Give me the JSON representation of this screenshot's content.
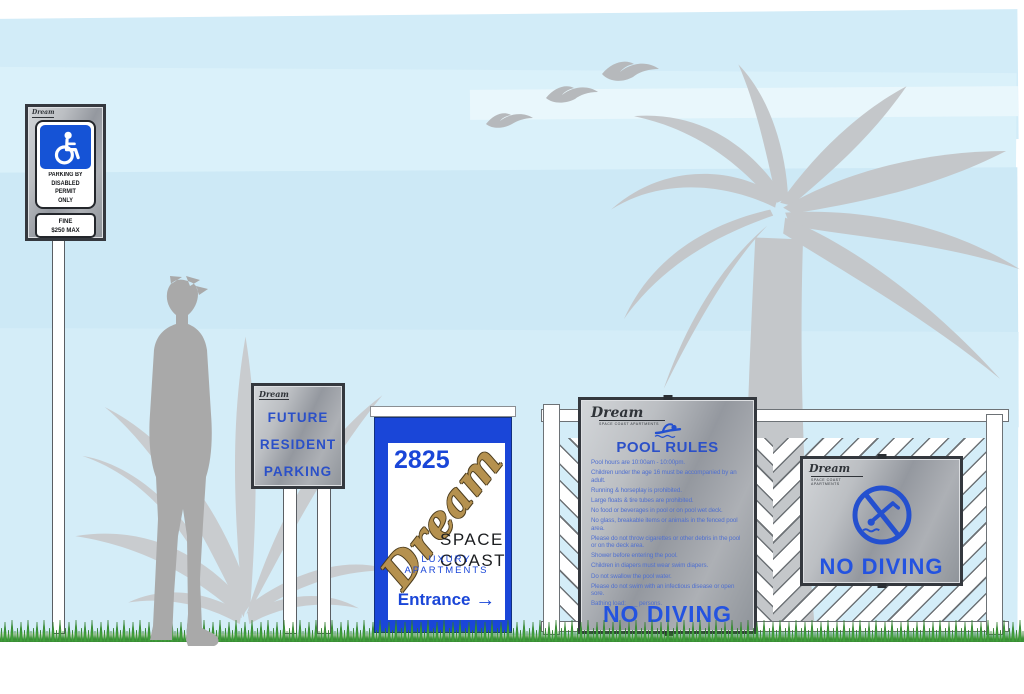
{
  "scene": {
    "description": "Signage package rendering for Dream Space Coast Luxury Apartments",
    "brand": "Dream",
    "brand_sub": "SPACE COAST APARTMENTS"
  },
  "signs": {
    "handicap": {
      "brand": "Dream",
      "permit_lines": [
        "PARKING BY",
        "DISABLED",
        "PERMIT",
        "ONLY"
      ],
      "fine_lines": [
        "FINE",
        "$250 MAX"
      ]
    },
    "future_parking": {
      "brand": "Dream",
      "lines": [
        "FUTURE",
        "RESIDENT",
        "PARKING"
      ]
    },
    "entrance": {
      "address": "2825",
      "brand_script": "Dream",
      "name_line1": "SPACE",
      "name_line2": "COAST",
      "subtitle": "LUXURY APARTMENTS",
      "entrance_label": "Entrance",
      "arrow": "→"
    },
    "pool_rules": {
      "brand": "Dream",
      "brand_sub": "SPACE COAST APARTMENTS",
      "title": "POOL RULES",
      "rules": [
        "Pool hours are 10:00am - 10:00pm.",
        "Children under the age 16 must be accompanied by an adult.",
        "Running & horseplay is prohibited.",
        "Large floats & tire tubes are prohibited.",
        "No food or beverages in pool or on pool wet deck.",
        "No glass, breakable items or animals in the fenced pool area.",
        "Please do not throw cigarettes or other debris in the pool or on the deck area.",
        "Shower before entering the pool.",
        "Children in diapers must wear swim diapers.",
        "Do not swallow the pool water.",
        "Please do not swim with an infectious disease or open sore.",
        "Bathing load: ___ persons."
      ],
      "footer": "NO DIVING"
    },
    "no_diving": {
      "brand": "Dream",
      "brand_sub": "SPACE COAST APARTMENTS",
      "label": "NO DIVING"
    }
  },
  "colors": {
    "sky": "#d2ecf8",
    "silhouette_gray": "#a9a9a9",
    "foliage_gray": "#c4c7ca",
    "sign_blue": "#2b50c8",
    "entrance_blue": "#1a46d8",
    "handicap_blue": "#1553d6",
    "brand_gold": "#b5914f",
    "silver": "#aeb2b6",
    "grass_green": "#3f9f3a"
  }
}
